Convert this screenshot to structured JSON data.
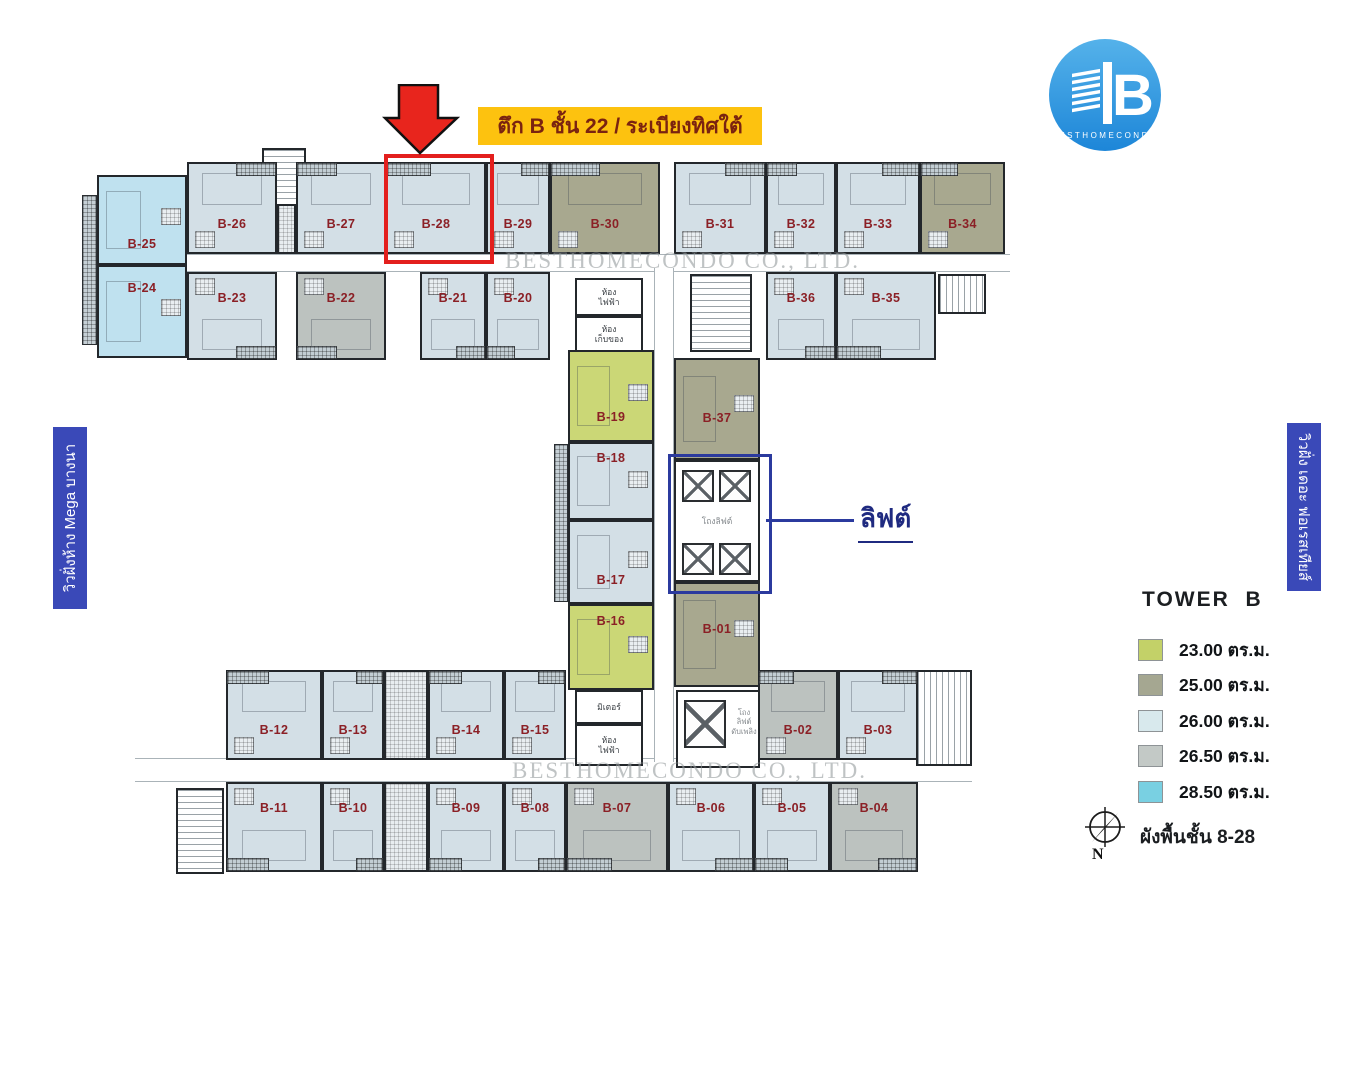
{
  "banners": {
    "title": "ตึก B ชั้น 22 / ระเบียงทิศใต้",
    "left_view": "วิวฝั่งห้าง Mega บางนา",
    "right_view": "วิวฝั่ง เดอะ ฟอเรสเทียส์"
  },
  "logo": {
    "name": "BESTHOMECONDO",
    "letter": "B"
  },
  "watermark": {
    "text": "BESTHOMECONDO CO., LTD."
  },
  "callout": {
    "elevator": "ลิฟต์"
  },
  "legend": {
    "title": "TOWER  B",
    "items": [
      {
        "area": "23.00 ตร.ม.",
        "color": "#c3d168"
      },
      {
        "area": "25.00 ตร.ม.",
        "color": "#a5a791"
      },
      {
        "area": "26.00 ตร.ม.",
        "color": "#d8e9ed"
      },
      {
        "area": "26.50 ตร.ม.",
        "color": "#c3c9c6"
      },
      {
        "area": "28.50 ตร.ม.",
        "color": "#79d0e2"
      }
    ],
    "compass_letter": "N",
    "floor_note": "ผังพื้นชั้น 8-28"
  },
  "plan": {
    "unit_fills": {
      "a23": "#cbd776",
      "a25": "#a8a88f",
      "a26": "#d3dfe6",
      "a265": "#bcc2bf",
      "a285": "#bfe1ef"
    },
    "room_labels": {
      "electrical": "ห้อง\nไฟฟ้า",
      "storage": "ห้อง\nเก็บของ",
      "meter": "มิเตอร์",
      "lift_hall": "โถงลิฟต์",
      "fire_lift": "โถง\nลิฟต์\nดับเพลิง"
    },
    "units": [
      {
        "id": "B-25",
        "x": 97,
        "y": 175,
        "w": 90,
        "h": 90,
        "t": "a285",
        "r": "side",
        "lp": 70
      },
      {
        "id": "B-24",
        "x": 97,
        "y": 265,
        "w": 90,
        "h": 93,
        "t": "a285",
        "r": "side",
        "lp": 16
      },
      {
        "id": "B-26",
        "x": 187,
        "y": 162,
        "w": 90,
        "h": 92,
        "t": "a26",
        "r": "up",
        "b": "r"
      },
      {
        "id": "B-27",
        "x": 296,
        "y": 162,
        "w": 90,
        "h": 92,
        "t": "a26",
        "r": "up",
        "b": "l"
      },
      {
        "id": "B-28",
        "x": 386,
        "y": 162,
        "w": 100,
        "h": 92,
        "t": "a26",
        "r": "up",
        "b": "l"
      },
      {
        "id": "B-29",
        "x": 486,
        "y": 162,
        "w": 64,
        "h": 92,
        "t": "a26",
        "r": "up",
        "b": "r"
      },
      {
        "id": "B-30",
        "x": 550,
        "y": 162,
        "w": 110,
        "h": 92,
        "t": "a25",
        "r": "up",
        "b": "l"
      },
      {
        "id": "B-31",
        "x": 674,
        "y": 162,
        "w": 92,
        "h": 92,
        "t": "a26",
        "r": "up",
        "b": "r"
      },
      {
        "id": "B-32",
        "x": 766,
        "y": 162,
        "w": 70,
        "h": 92,
        "t": "a26",
        "r": "up",
        "b": "l"
      },
      {
        "id": "B-33",
        "x": 836,
        "y": 162,
        "w": 84,
        "h": 92,
        "t": "a26",
        "r": "up",
        "b": "r"
      },
      {
        "id": "B-34",
        "x": 920,
        "y": 162,
        "w": 85,
        "h": 92,
        "t": "a25",
        "r": "up",
        "b": "l"
      },
      {
        "id": "B-23",
        "x": 187,
        "y": 272,
        "w": 90,
        "h": 88,
        "t": "a26",
        "r": "down",
        "b": "r"
      },
      {
        "id": "B-22",
        "x": 296,
        "y": 272,
        "w": 90,
        "h": 88,
        "t": "a265",
        "r": "down",
        "b": "l"
      },
      {
        "id": "B-21",
        "x": 420,
        "y": 272,
        "w": 66,
        "h": 88,
        "t": "a26",
        "r": "down",
        "b": "r"
      },
      {
        "id": "B-20",
        "x": 486,
        "y": 272,
        "w": 64,
        "h": 88,
        "t": "a26",
        "r": "down",
        "b": "l"
      },
      {
        "id": "B-36",
        "x": 766,
        "y": 272,
        "w": 70,
        "h": 88,
        "t": "a26",
        "r": "down",
        "b": "r"
      },
      {
        "id": "B-35",
        "x": 836,
        "y": 272,
        "w": 100,
        "h": 88,
        "t": "a26",
        "r": "down",
        "b": "l"
      },
      {
        "id": "B-19",
        "x": 568,
        "y": 350,
        "w": 86,
        "h": 92,
        "t": "a23",
        "r": "side",
        "lp": 66
      },
      {
        "id": "B-18",
        "x": 568,
        "y": 442,
        "w": 86,
        "h": 78,
        "t": "a26",
        "r": "side",
        "lp": 10
      },
      {
        "id": "B-17",
        "x": 568,
        "y": 520,
        "w": 86,
        "h": 84,
        "t": "a26",
        "r": "side",
        "lp": 64
      },
      {
        "id": "B-16",
        "x": 568,
        "y": 604,
        "w": 86,
        "h": 86,
        "t": "a23",
        "r": "side",
        "lp": 10
      },
      {
        "id": "B-37",
        "x": 674,
        "y": 358,
        "w": 86,
        "h": 102,
        "t": "a25",
        "r": "side",
        "lp": 52
      },
      {
        "id": "B-01",
        "x": 674,
        "y": 582,
        "w": 86,
        "h": 105,
        "t": "a25",
        "r": "side",
        "lp": 38
      },
      {
        "id": "B-12",
        "x": 226,
        "y": 670,
        "w": 96,
        "h": 90,
        "t": "a26",
        "r": "up",
        "b": "l"
      },
      {
        "id": "B-13",
        "x": 322,
        "y": 670,
        "w": 62,
        "h": 90,
        "t": "a26",
        "r": "up",
        "b": "r"
      },
      {
        "id": "B-14",
        "x": 428,
        "y": 670,
        "w": 76,
        "h": 90,
        "t": "a26",
        "r": "up",
        "b": "l"
      },
      {
        "id": "B-15",
        "x": 504,
        "y": 670,
        "w": 62,
        "h": 90,
        "t": "a26",
        "r": "up",
        "b": "r"
      },
      {
        "id": "B-02",
        "x": 758,
        "y": 670,
        "w": 80,
        "h": 90,
        "t": "a265",
        "r": "up",
        "b": "l"
      },
      {
        "id": "B-03",
        "x": 838,
        "y": 670,
        "w": 80,
        "h": 90,
        "t": "a26",
        "r": "up",
        "b": "r"
      },
      {
        "id": "B-11",
        "x": 226,
        "y": 782,
        "w": 96,
        "h": 90,
        "t": "a26",
        "r": "down",
        "b": "l"
      },
      {
        "id": "B-10",
        "x": 322,
        "y": 782,
        "w": 62,
        "h": 90,
        "t": "a26",
        "r": "down",
        "b": "r"
      },
      {
        "id": "B-09",
        "x": 428,
        "y": 782,
        "w": 76,
        "h": 90,
        "t": "a26",
        "r": "down",
        "b": "l"
      },
      {
        "id": "B-08",
        "x": 504,
        "y": 782,
        "w": 62,
        "h": 90,
        "t": "a26",
        "r": "down",
        "b": "r"
      },
      {
        "id": "B-07",
        "x": 566,
        "y": 782,
        "w": 102,
        "h": 90,
        "t": "a265",
        "r": "down",
        "b": "l"
      },
      {
        "id": "B-06",
        "x": 668,
        "y": 782,
        "w": 86,
        "h": 90,
        "t": "a26",
        "r": "down",
        "b": "r"
      },
      {
        "id": "B-05",
        "x": 754,
        "y": 782,
        "w": 76,
        "h": 90,
        "t": "a26",
        "r": "down",
        "b": "l"
      },
      {
        "id": "B-04",
        "x": 830,
        "y": 782,
        "w": 88,
        "h": 90,
        "t": "a265",
        "r": "down",
        "b": "r"
      }
    ],
    "blocks": [
      {
        "t": "cor",
        "o": "h",
        "x": 95,
        "y": 254,
        "w": 915,
        "h": 18
      },
      {
        "t": "cor",
        "o": "h",
        "x": 135,
        "y": 758,
        "w": 837,
        "h": 24
      },
      {
        "t": "cor",
        "o": "v",
        "x": 654,
        "y": 268,
        "w": 20,
        "h": 494
      },
      {
        "t": "hatch",
        "x": 82,
        "y": 195,
        "w": 15,
        "h": 150
      },
      {
        "t": "bath",
        "x": 277,
        "y": 162,
        "w": 19,
        "h": 92
      },
      {
        "t": "stairh",
        "x": 262,
        "y": 148,
        "w": 44,
        "h": 58
      },
      {
        "t": "util",
        "x": 575,
        "y": 278,
        "w": 68,
        "h": 38,
        "lbl": "electrical"
      },
      {
        "t": "util",
        "x": 575,
        "y": 316,
        "w": 68,
        "h": 36,
        "lbl": "storage"
      },
      {
        "t": "stairh",
        "x": 690,
        "y": 274,
        "w": 62,
        "h": 78
      },
      {
        "t": "stairv",
        "x": 938,
        "y": 274,
        "w": 48,
        "h": 40
      },
      {
        "t": "hatch",
        "x": 554,
        "y": 444,
        "w": 14,
        "h": 158
      },
      {
        "t": "lobby",
        "x": 674,
        "y": 460,
        "w": 86,
        "h": 122
      },
      {
        "t": "shaft",
        "x": 682,
        "y": 470,
        "w": 32,
        "h": 32
      },
      {
        "t": "shaft",
        "x": 719,
        "y": 470,
        "w": 32,
        "h": 32
      },
      {
        "t": "shaft",
        "x": 682,
        "y": 543,
        "w": 32,
        "h": 32
      },
      {
        "t": "shaft",
        "x": 719,
        "y": 543,
        "w": 32,
        "h": 32
      },
      {
        "t": "rlabel",
        "x": 674,
        "y": 514,
        "w": 86,
        "h": 14,
        "lbl": "lift_hall",
        "fs": 8.5
      },
      {
        "t": "util",
        "x": 575,
        "y": 690,
        "w": 68,
        "h": 34,
        "lbl": "meter"
      },
      {
        "t": "util",
        "x": 575,
        "y": 724,
        "w": 68,
        "h": 42,
        "lbl": "electrical"
      },
      {
        "t": "lobby",
        "x": 676,
        "y": 690,
        "w": 84,
        "h": 78
      },
      {
        "t": "shaft",
        "x": 684,
        "y": 700,
        "w": 42,
        "h": 48
      },
      {
        "t": "rlabel",
        "x": 726,
        "y": 692,
        "w": 36,
        "h": 60,
        "lbl": "fire_lift",
        "fs": 7.5
      },
      {
        "t": "bath",
        "x": 384,
        "y": 670,
        "w": 44,
        "h": 90
      },
      {
        "t": "bath",
        "x": 384,
        "y": 782,
        "w": 44,
        "h": 90
      },
      {
        "t": "stairh",
        "x": 176,
        "y": 788,
        "w": 48,
        "h": 86
      },
      {
        "t": "stairv",
        "x": 916,
        "y": 670,
        "w": 56,
        "h": 96
      }
    ]
  }
}
